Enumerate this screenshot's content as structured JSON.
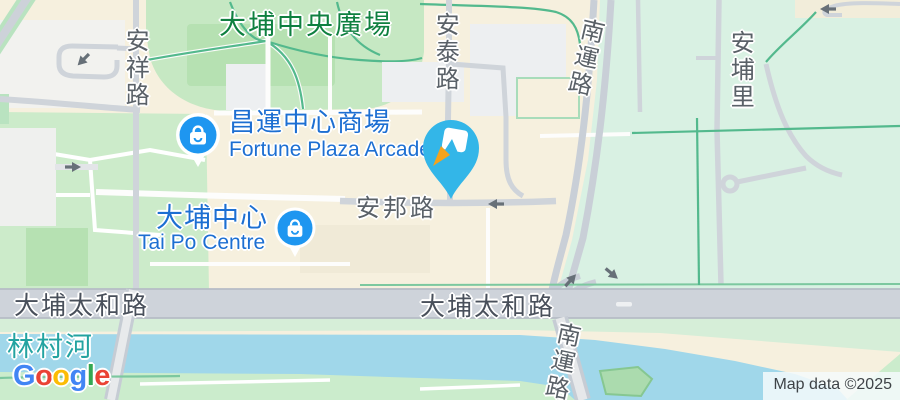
{
  "map_labels": {
    "central_plaza_park": "大埔中央廣場",
    "on_cheung_road": "安祥路",
    "on_tai_road": "安泰路",
    "nam_wan_road_top": "南運路",
    "on_po_lane": "安埔里",
    "fortune_plaza_zh": "昌運中心商場",
    "fortune_plaza_en": "Fortune Plaza Arcade",
    "tai_po_centre_zh": "大埔中心",
    "tai_po_centre_en": "Tai Po Centre",
    "on_pong_road": "安邦路",
    "tai_po_tai_wo_road_left": "大埔太和路",
    "tai_po_tai_wo_road_center": "大埔太和路",
    "nam_wan_road_bottom": "南運路",
    "lam_tsuen_river": "林村河"
  },
  "markers": {
    "fortune_plaza": {
      "type": "shopping-mall",
      "color": "#1e96f0"
    },
    "tai_po_centre": {
      "type": "shopping-mall",
      "color": "#1e96f0"
    },
    "selected_place": {
      "type": "pen-pin",
      "color": "#33b6e8",
      "pen_tip_color": "#f5a31c"
    }
  },
  "watermark": {
    "letters": [
      {
        "ch": "G",
        "color": "#4285F4"
      },
      {
        "ch": "o",
        "color": "#EA4335"
      },
      {
        "ch": "o",
        "color": "#FBBC05"
      },
      {
        "ch": "g",
        "color": "#4285F4"
      },
      {
        "ch": "l",
        "color": "#34A853"
      },
      {
        "ch": "e",
        "color": "#EA4335"
      }
    ]
  },
  "attribution": "Map data ©2025",
  "colors": {
    "land": "#f6f0de",
    "park_green": "#c6e8c3",
    "mint_green": "#d9f1e3",
    "water": "#a0d7ea",
    "road_gray": "#ccd1d8",
    "highway_gray": "#ced3da",
    "path_teal": "#53b98d",
    "poi_blue": "#1d6fd2",
    "park_label_green": "#0f8040",
    "river_label_teal": "#23a3a1",
    "road_label_gray": "#5a6168"
  }
}
